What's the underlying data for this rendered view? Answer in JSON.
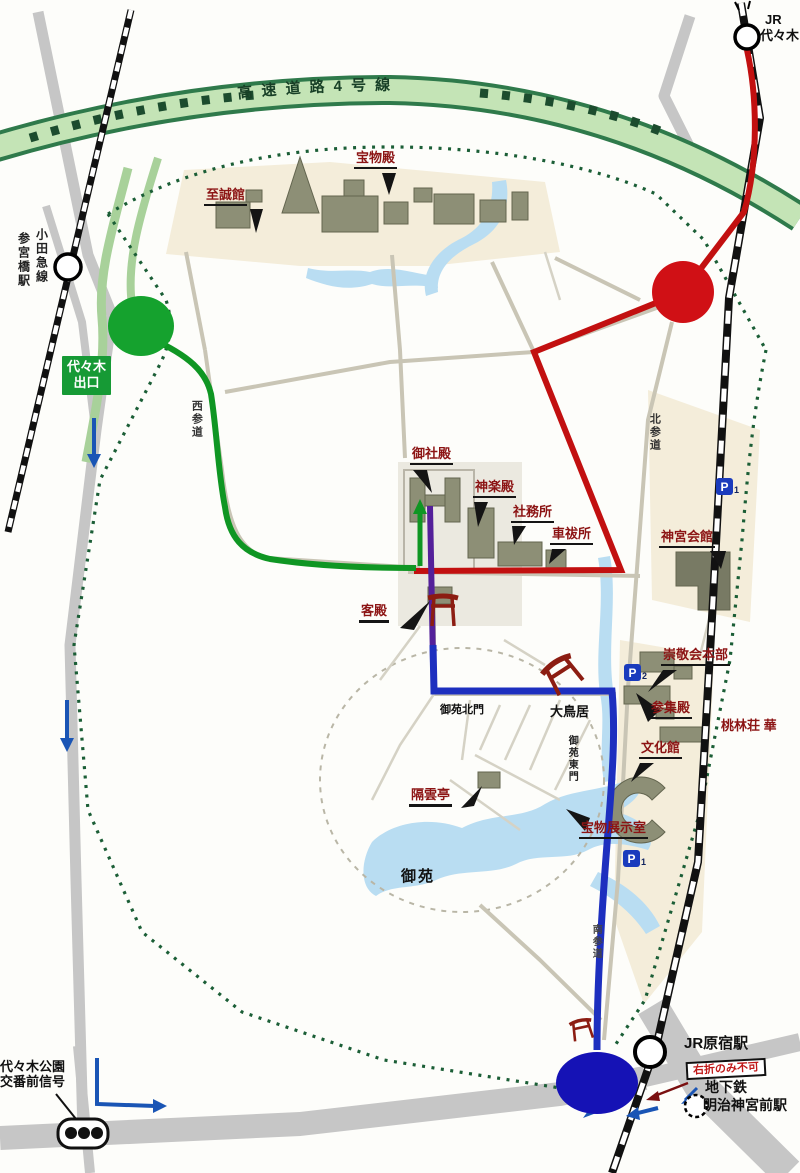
{
  "colors": {
    "route_red": "#c21010",
    "route_green": "#0f9623",
    "route_blue": "#1d2fbf",
    "route_purple": "#54209a",
    "exit_green": "#169a35",
    "station_circle_blue": "#1512b5",
    "junction_circle_red": "#d01015",
    "junction_circle_green": "#15a22e",
    "parking_blue": "#1a3bbd",
    "facility_label_red": "#8c1414",
    "expressway_band_green": "#c4e4b6"
  },
  "expressway": {
    "label": "高速道路4号線"
  },
  "stations": {
    "jr_yoyogi": {
      "line1": "JR",
      "line2": "代々木"
    },
    "odakyu_line": "小田急線",
    "sangubashi": "参宮橋駅",
    "jr_harajuku": "JR原宿駅",
    "subway": "地下鉄",
    "meiji_jingumae": "明治神宮前駅"
  },
  "boxes": {
    "yoyogi_exit": {
      "line1": "代々木",
      "line2": "出口"
    },
    "no_right_turn": "右折のみ不可",
    "signal": {
      "line1": "代々木公園",
      "line2": "交番前信号"
    }
  },
  "facility_labels": {
    "homotsuden": "宝物殿",
    "shiseikan": "至誠館",
    "goshaden": "御社殿",
    "kaguraden": "神楽殿",
    "shamusho": "社務所",
    "kuruma_haraisho": "車祓所",
    "jingu_kaikan": "神宮会館",
    "kyakuden": "客殿",
    "sukeikai_honbu": "崇敬会本部",
    "sanshuden": "参集殿",
    "bunkakan": "文化館",
    "torinso": "桃林荘 華",
    "kakuuntei": "隔雲亭",
    "homotsu_tenjishitsu": "宝物展示室"
  },
  "place_labels": {
    "otorii": "大鳥居",
    "gyoen_kitamon": "御苑北門",
    "gyoen": "御苑",
    "nishisando": "西参道",
    "kitasando": "北参道",
    "gyoen_higashimon": "御苑東門",
    "minamisando": "南参道"
  },
  "parking": {
    "p_top": {
      "letter": "P",
      "num": "1"
    },
    "p_mid": {
      "letter": "P",
      "num": "2"
    },
    "p_bottom": {
      "letter": "P",
      "num": "1"
    }
  }
}
